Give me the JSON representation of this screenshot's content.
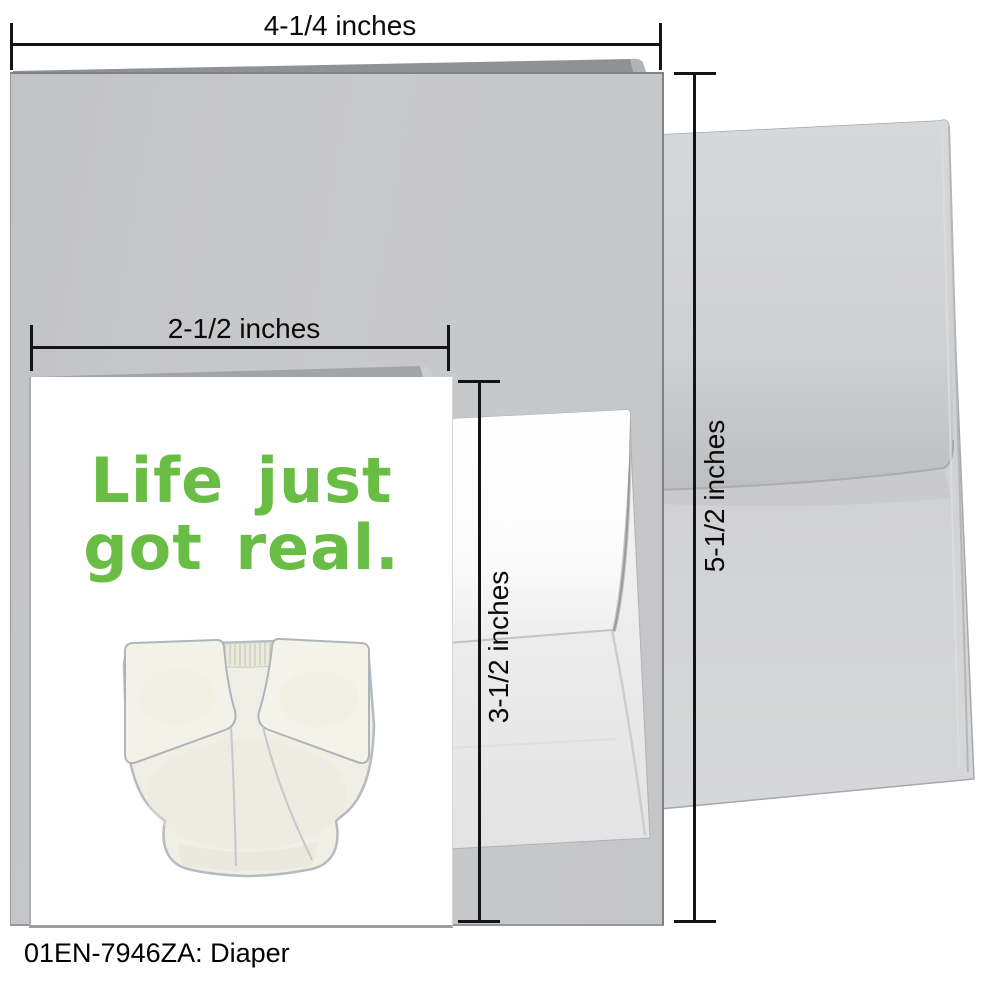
{
  "caption": "01EN-7946ZA: Diaper",
  "dimension_labels": {
    "large_card_width": "4-1/4 inches",
    "large_card_height": "5-1/2 inches",
    "small_card_width": "2-1/2 inches",
    "small_card_height": "3-1/2 inches"
  },
  "card_front": {
    "message_line1": "Life just",
    "message_line2": "got real.",
    "message_color": "#69bd45",
    "illustration": "watercolor cloth diaper"
  },
  "colors": {
    "large_card_gray": "#c6c7c9",
    "large_envelope_gray": "#d0d1d3",
    "small_envelope_white": "#f3f3f4",
    "dimension_line_black": "#141414"
  }
}
